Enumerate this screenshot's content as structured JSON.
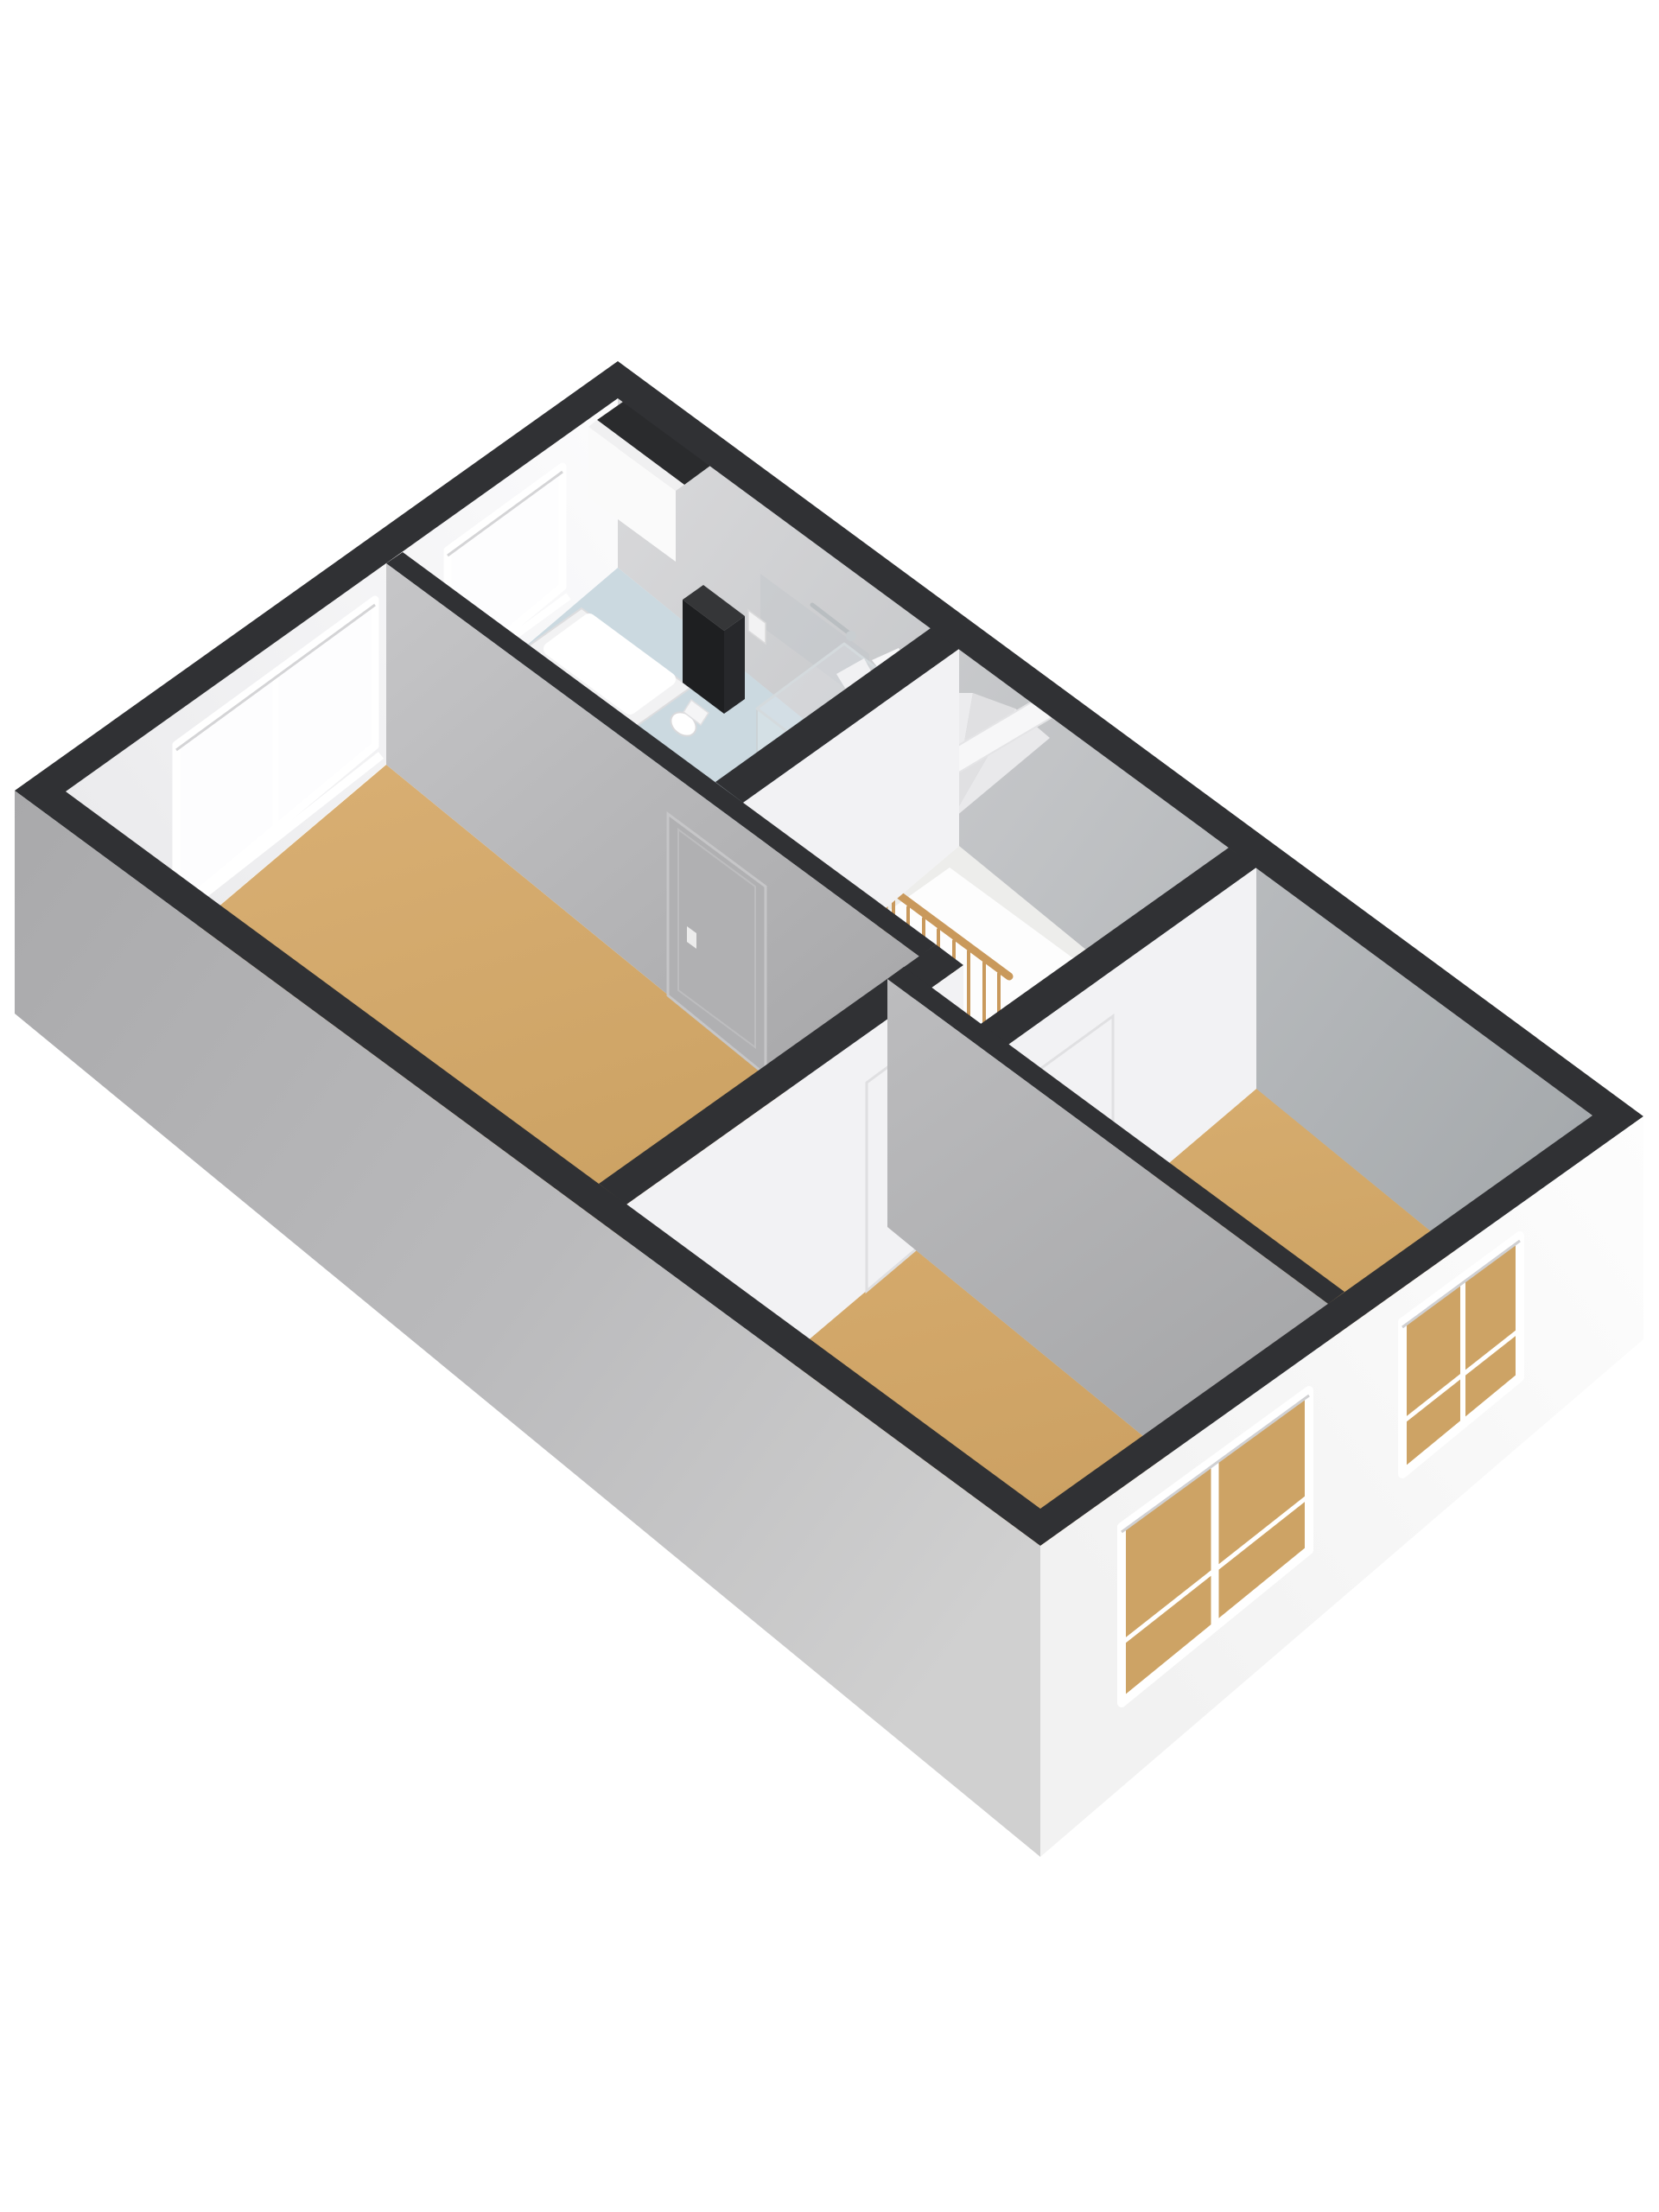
{
  "meta": {
    "title": "3D floor plan render — upper floor (axonometric view)",
    "render_type": "isometric-floorplan",
    "background": "#ffffff"
  },
  "palette": {
    "wall_top": "#303134",
    "niche_dark": "#2a2b2d",
    "wall_interior_white": "#f2f2f4",
    "door_gray": "#b0b0b2",
    "floor_wood": "#cda365",
    "floor_bathroom": "#cbd9e0",
    "floor_landing": "#ededeb",
    "stair_void": "#fdfdfd",
    "railing_wood": "#c9995c",
    "cabinet_front": "#1e1f21",
    "cabinet_top": "#353638",
    "cabinet_side": "#27282b",
    "window_glow": "#fdfdfe",
    "frame_white": "#ffffff"
  },
  "rooms": [
    {
      "name": "bathroom",
      "floor": "light-blue tile",
      "fixtures": [
        "bathtub",
        "toilet",
        "shower-enclosure",
        "tall-dark-cabinet",
        "wall-faucet",
        "duct-niche"
      ]
    },
    {
      "name": "landing-stairwell",
      "floor": "light gray",
      "features": [
        "winder-staircase",
        "stair-void",
        "wooden-railing",
        "upper-flight-plank"
      ]
    },
    {
      "name": "room-left",
      "floor": "wood",
      "features": [
        "double-window-nw",
        "gray-door"
      ]
    },
    {
      "name": "room-middle",
      "floor": "wood",
      "features": [
        "double-window-se",
        "white-door"
      ]
    },
    {
      "name": "room-right",
      "floor": "wood",
      "features": [
        "single-window-se",
        "white-door"
      ]
    }
  ],
  "openings": {
    "windows_total": 4,
    "doors_total": 3,
    "nw_wall_windows": [
      "bathroom-small-window",
      "room-left-double-window"
    ],
    "se_wall_windows": [
      "room-right-single-window",
      "room-middle-double-window"
    ]
  },
  "view": {
    "camera": "bird's-eye from south",
    "walls_cut": "full-height, dark cap on top of all walls"
  }
}
